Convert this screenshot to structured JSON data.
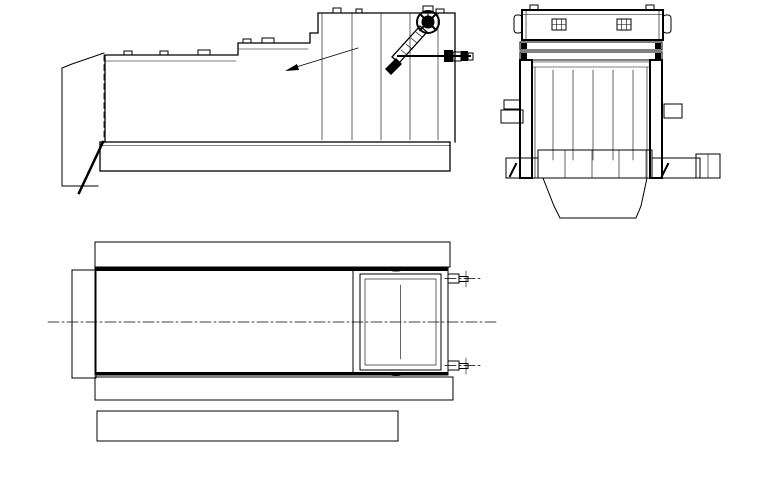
{
  "meta": {
    "description": "Three-view engineering CAD drawing of a multi-stand section roll forming machine with individual gear-motor drives",
    "background_color": "#ffffff",
    "line_color": "#000000",
    "divider_color": "#9a9a9a",
    "canvas": {
      "width": 761,
      "height": 492
    }
  },
  "side_elevation": {
    "stands": {
      "count": 10,
      "x_start": 121,
      "x_spacing": 27.7,
      "roll_center_y": [
        127,
        126,
        125,
        124,
        123,
        122,
        112,
        104,
        96,
        88
      ],
      "housing_top_y": [
        61,
        61,
        61,
        61,
        61,
        49,
        49,
        39,
        19,
        19
      ]
    },
    "anchor_bolts": {
      "count": 10,
      "x_start": 109,
      "x_spacing": 27.7,
      "y": 156,
      "extra_dividers_x": [
        400,
        426
      ]
    },
    "base": {
      "x": 100,
      "y": 142,
      "width": 350,
      "height": 29
    },
    "pass_line": {
      "x1": 103,
      "y1": 129,
      "x2": 400,
      "y2": 84
    },
    "foundation_blocks": [
      {
        "x": 99,
        "y": 172,
        "w": 19,
        "h": 41
      },
      {
        "x": 430,
        "y": 172,
        "w": 19,
        "h": 38
      }
    ],
    "handwheel": {
      "cx": 428,
      "cy": 22,
      "r": 11
    },
    "thread_ticks": {
      "x_start": 401,
      "count": 12,
      "spacing": 3.6,
      "y": 56,
      "half_len": 4
    }
  },
  "end_view": {
    "discs": {
      "count": 11,
      "x_start": 545,
      "x_spacing": 10,
      "height": 28,
      "width": 3.2
    },
    "shaft_y": [
      89,
      133
    ],
    "shaft_x_extent": [
      500,
      760
    ],
    "bearings": {
      "left_x": 506,
      "right_x": 662,
      "width": 14
    },
    "drive_units": {
      "count": 2,
      "coupling_x": 674,
      "gearbox_x": 700,
      "motor_x": 726
    },
    "foundation_hatch_rects": [
      {
        "x": 505,
        "y": 178,
        "w": 18,
        "h": 17
      },
      {
        "x": 523,
        "y": 178,
        "w": 20,
        "h": 35
      },
      {
        "x": 647,
        "y": 178,
        "w": 20,
        "h": 35
      },
      {
        "x": 667,
        "y": 178,
        "w": 68,
        "h": 17
      }
    ]
  },
  "plan_view": {
    "columns": {
      "count": 10,
      "x_start": 121,
      "x_spacing": 27.7,
      "paneled_count": 8
    },
    "panels": [
      {
        "x": 103,
        "w": 67
      },
      {
        "x": 173,
        "w": 63
      },
      {
        "x": 244,
        "w": 62
      },
      {
        "x": 309,
        "w": 35
      }
    ],
    "panel_y": 273,
    "panel_h": 98,
    "dividers": [
      {
        "x": 237,
        "w": 3
      },
      {
        "x": 241.5,
        "w": 3
      },
      {
        "x": 306.5,
        "w": 2.5
      }
    ],
    "center_y": 322,
    "centerline_x": [
      48,
      497
    ],
    "column_line_y": [
      239,
      488
    ]
  }
}
